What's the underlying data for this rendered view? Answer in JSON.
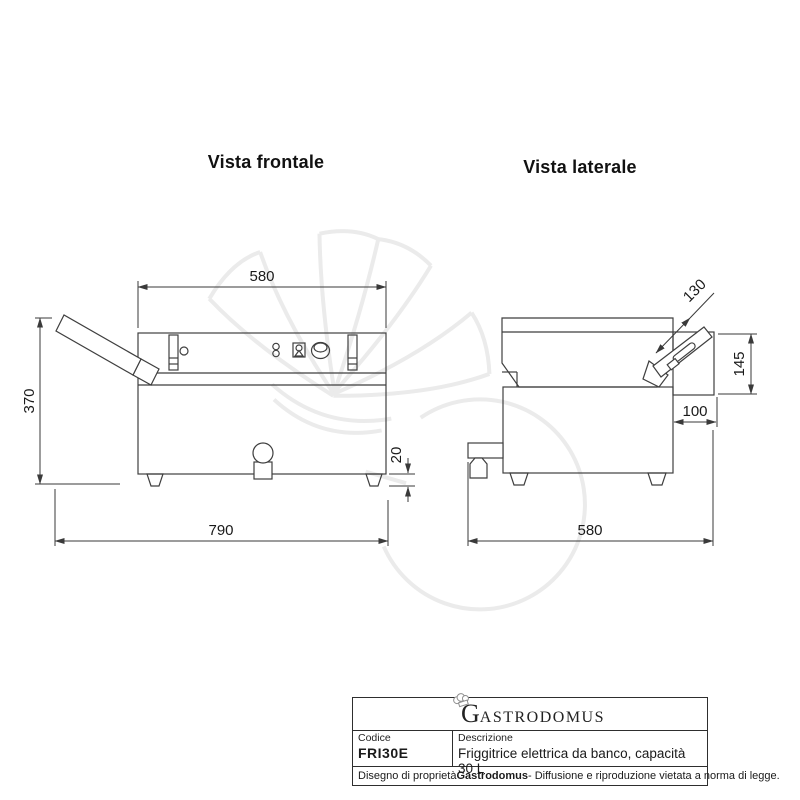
{
  "views": {
    "front": {
      "title": "Vista frontale",
      "dims": {
        "width_top": "580",
        "height": "370",
        "feet_height": "20",
        "width_total": "790"
      }
    },
    "side": {
      "title": "Vista laterale",
      "dims": {
        "handle_length": "130",
        "back_height": "145",
        "back_depth": "100",
        "depth": "580"
      }
    }
  },
  "footer": {
    "logo_initial": "G",
    "logo_rest": "ASTRODOMUS",
    "code_label": "Codice",
    "code_value": "FRI30E",
    "desc_label": "Descrizione",
    "desc_value": "Friggitrice elettrica da banco, capacità 30 L",
    "note_prefix": "Disegno di proprietà ",
    "note_brand": "Gastrodomus",
    "note_suffix": " - Diffusione e riproduzione vietata a norma di legge."
  },
  "colors": {
    "line": "#3f3f3f",
    "dim_text": "#1a1a1a",
    "watermark": "#ebebeb"
  }
}
